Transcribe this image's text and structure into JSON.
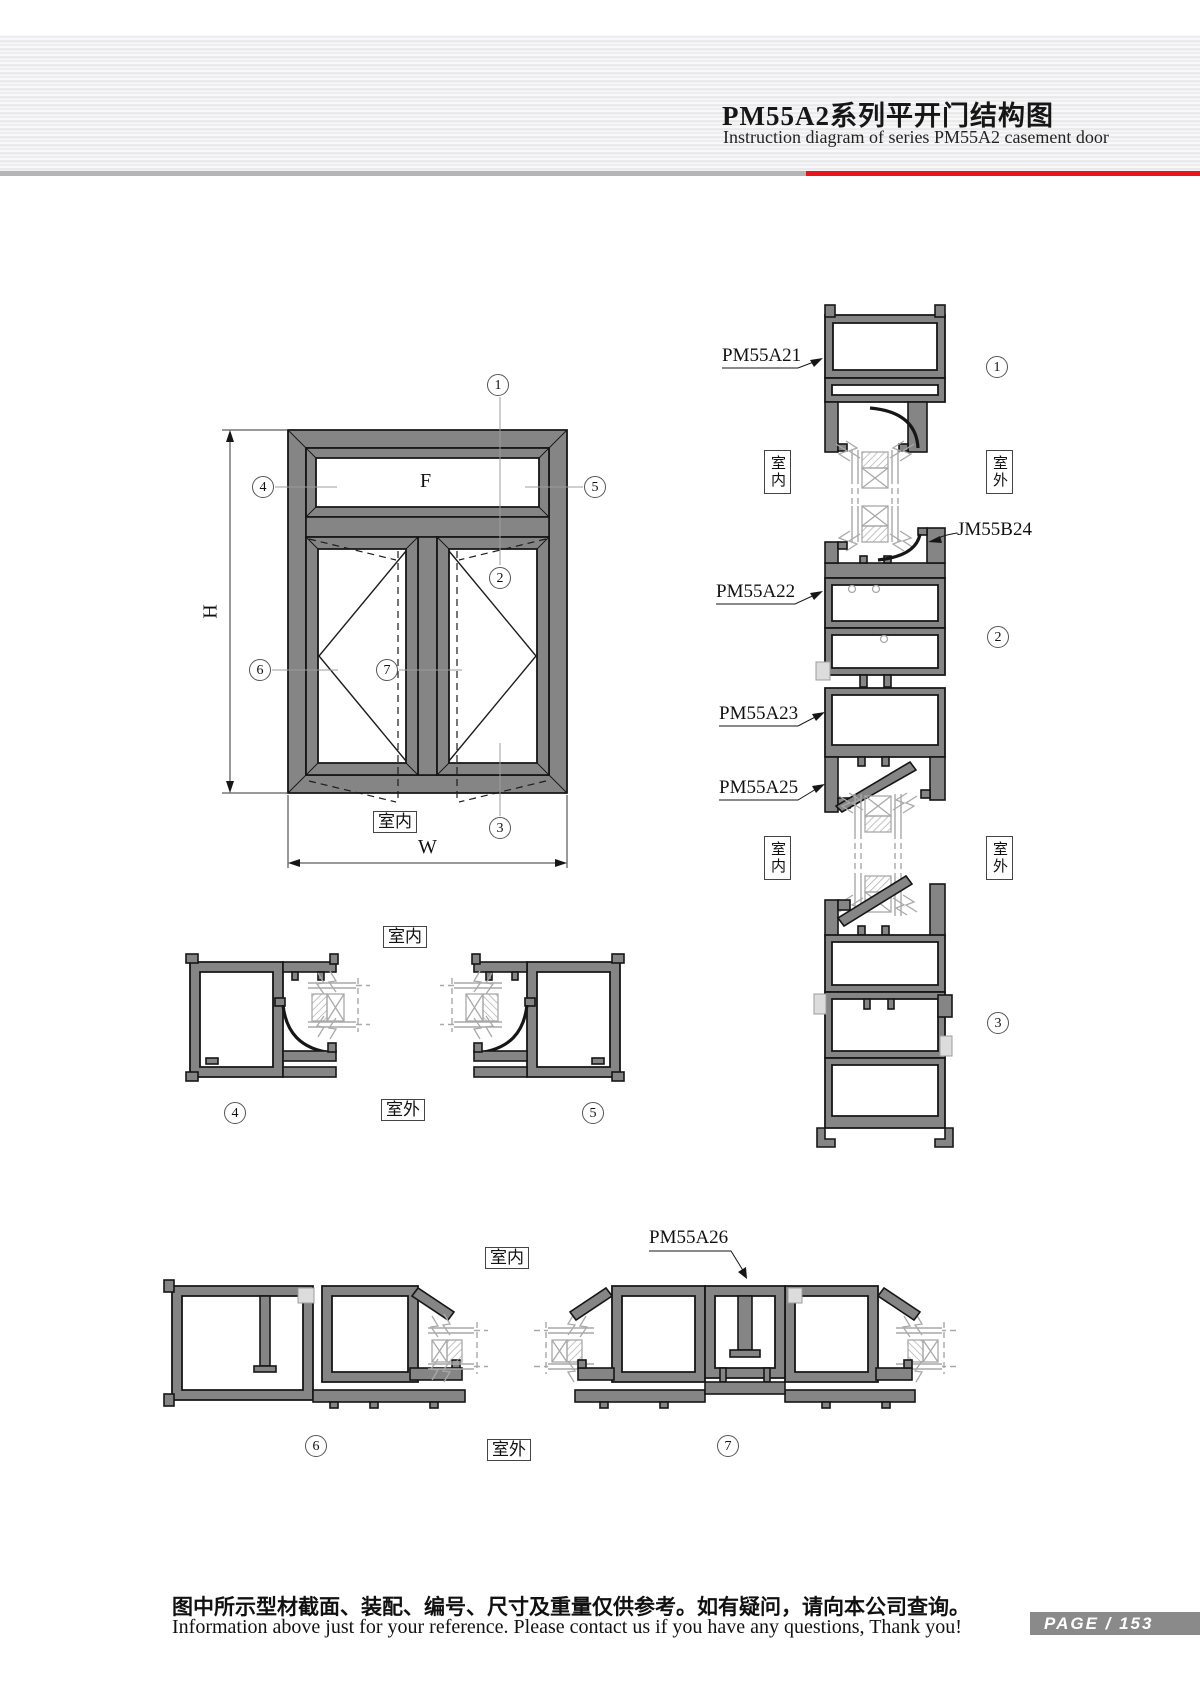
{
  "header": {
    "title": "PM55A2系列平开门结构图",
    "subtitle": "Instruction diagram of series PM55A2 casement door"
  },
  "elevation": {
    "glass_label": "F",
    "height_label": "H",
    "width_label": "W",
    "indoor": "室内",
    "callouts": {
      "n1": "1",
      "n2": "2",
      "n3": "3",
      "n4": "4",
      "n5": "5",
      "n6": "6",
      "n7": "7"
    }
  },
  "sections": {
    "right": {
      "labels": {
        "pm55a21": "PM55A21",
        "jm55b24": "JM55B24",
        "pm55a22": "PM55A22",
        "pm55a23": "PM55A23",
        "pm55a25": "PM55A25"
      },
      "callouts": {
        "n1": "1",
        "n2": "2",
        "n3": "3"
      },
      "indoor": "室内",
      "outdoor": "室外"
    },
    "middle": {
      "callouts": {
        "n4": "4",
        "n5": "5"
      },
      "indoor": "室内",
      "outdoor": "室外"
    },
    "bottom": {
      "label_pm55a26": "PM55A26",
      "callouts": {
        "n6": "6",
        "n7": "7"
      },
      "indoor": "室内",
      "outdoor": "室外"
    }
  },
  "footer": {
    "note_zh": "图中所示型材截面、装配、编号、尺寸及重量仅供参考。如有疑问，请向本公司查询。",
    "note_en": "Information above just for your reference. Please contact us if you have any questions, Thank you!",
    "page_badge": "PAGE / 153"
  },
  "colors": {
    "accent_red": "#e8151c",
    "divider_gray": "#b5b5b5",
    "profile_gray": "#858585",
    "glass_gray": "#a9a9a9",
    "badge_gray": "#8a8a8a"
  }
}
